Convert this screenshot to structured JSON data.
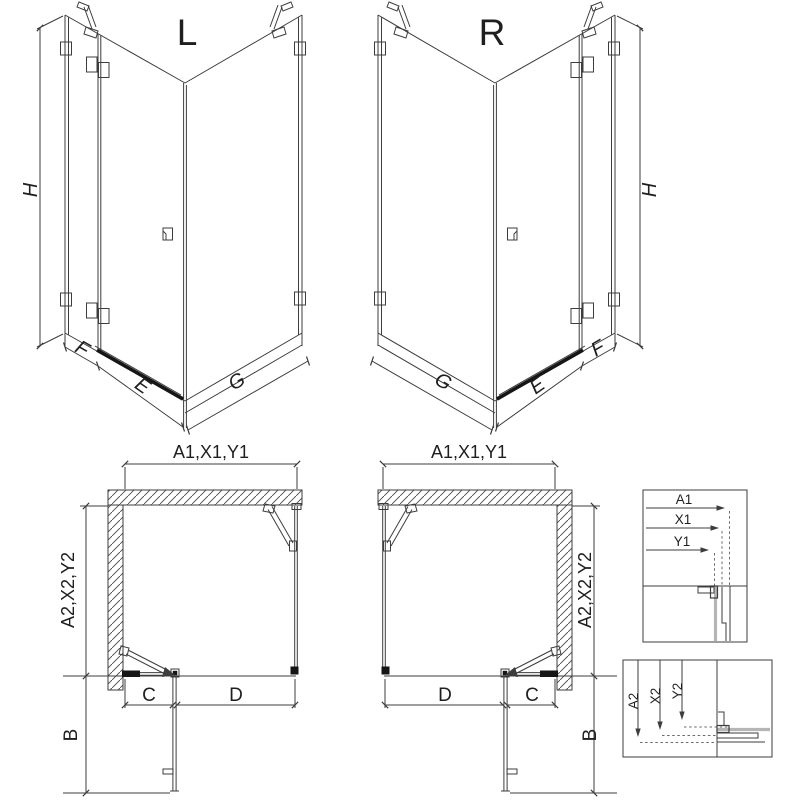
{
  "document": {
    "type": "technical-drawing",
    "subject": "corner shower enclosure — left (L) and right (R) versions, 3D views, plan views and measurement detail boxes"
  },
  "labels": {
    "view_left": "L",
    "view_right": "R",
    "height": "H",
    "panel_f": "F",
    "panel_e": "E",
    "panel_g": "G",
    "plan_width_top": "A1,X1,Y1",
    "plan_depth_side": "A2,X2,Y2",
    "door_projection": "B",
    "segment_c": "C",
    "segment_d": "D",
    "detail_top": {
      "a1": "A1",
      "x1": "X1",
      "y1": "Y1"
    },
    "detail_bottom": {
      "a2": "A2",
      "x2": "X2",
      "y2": "Y2"
    }
  },
  "colors": {
    "line": "#3d3d3d",
    "dark": "#161616",
    "glass_gray": "#b5b5b5",
    "text": "#1f1f1f",
    "background": "#ffffff"
  }
}
